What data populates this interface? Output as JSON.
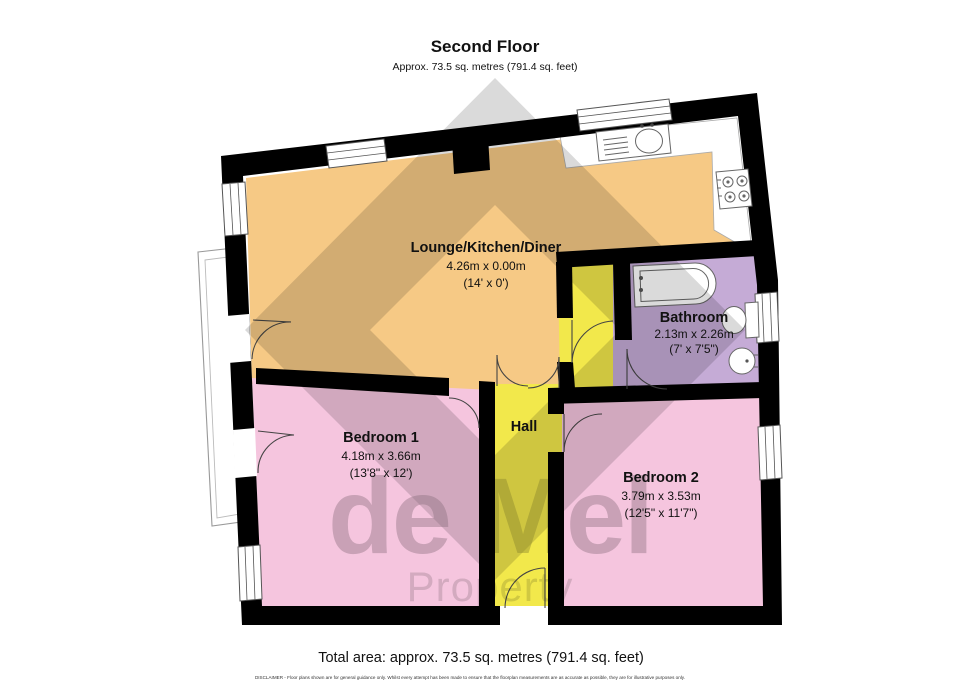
{
  "header": {
    "title": "Second Floor",
    "subtitle": "Approx. 73.5 sq. metres (791.4 sq. feet)"
  },
  "rooms": {
    "lounge": {
      "name": "Lounge/Kitchen/Diner",
      "dims_m": "4.26m x 0.00m",
      "dims_ft": "(14' x 0')"
    },
    "bathroom": {
      "name": "Bathroom",
      "dims_m": "2.13m x 2.26m",
      "dims_ft": "(7' x 7'5\")"
    },
    "bedroom1": {
      "name": "Bedroom 1",
      "dims_m": "4.18m x 3.66m",
      "dims_ft": "(13'8\" x 12')"
    },
    "hall": {
      "name": "Hall"
    },
    "bedroom2": {
      "name": "Bedroom 2",
      "dims_m": "3.79m x 3.53m",
      "dims_ft": "(12'5\" x 11'7\")"
    }
  },
  "watermark": {
    "line1": "de Mel",
    "line2": "Property"
  },
  "footer": {
    "total": "Total area: approx. 73.5 sq. metres (791.4 sq. feet)",
    "disclaimer": "DISCLAIMER -  Floor plans shown are for general guidance only. Whilst every attempt has been made to ensure that the floorplan measurements are as accurate as possible, they are for illustrative purposes only."
  },
  "colors": {
    "lounge": "#F6C985",
    "bedroom": "#F5C5DE",
    "hall": "#F2E84B",
    "bathroom": "#C5ABD6",
    "wall": "#000000",
    "watermark": "#8C8C8C"
  }
}
